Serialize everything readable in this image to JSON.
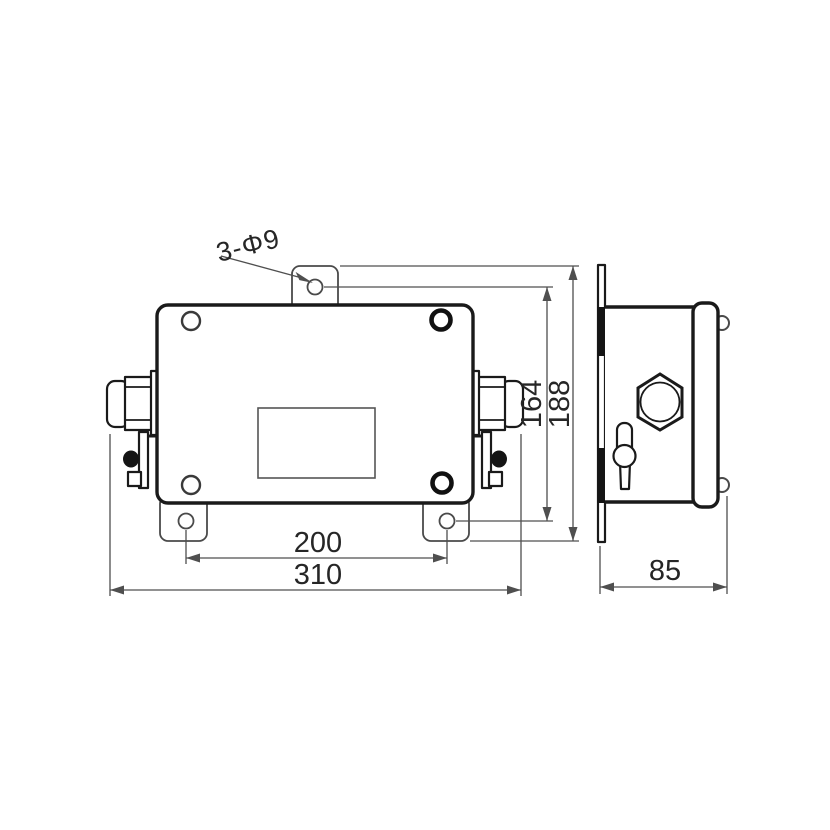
{
  "drawing": {
    "type": "technical-drawing",
    "description": "junction box outline drawing, front view and side view",
    "callout": {
      "hole_label": "3-Φ9"
    },
    "dimensions": {
      "mount_hole_spacing_horizontal": "200",
      "overall_width": "310",
      "mount_hole_spacing_vertical": "164",
      "overall_height": "188",
      "depth": "85"
    },
    "colors": {
      "object_line": "#1a1a1a",
      "dimension_line": "#4f4f4f",
      "background": "#ffffff"
    }
  }
}
